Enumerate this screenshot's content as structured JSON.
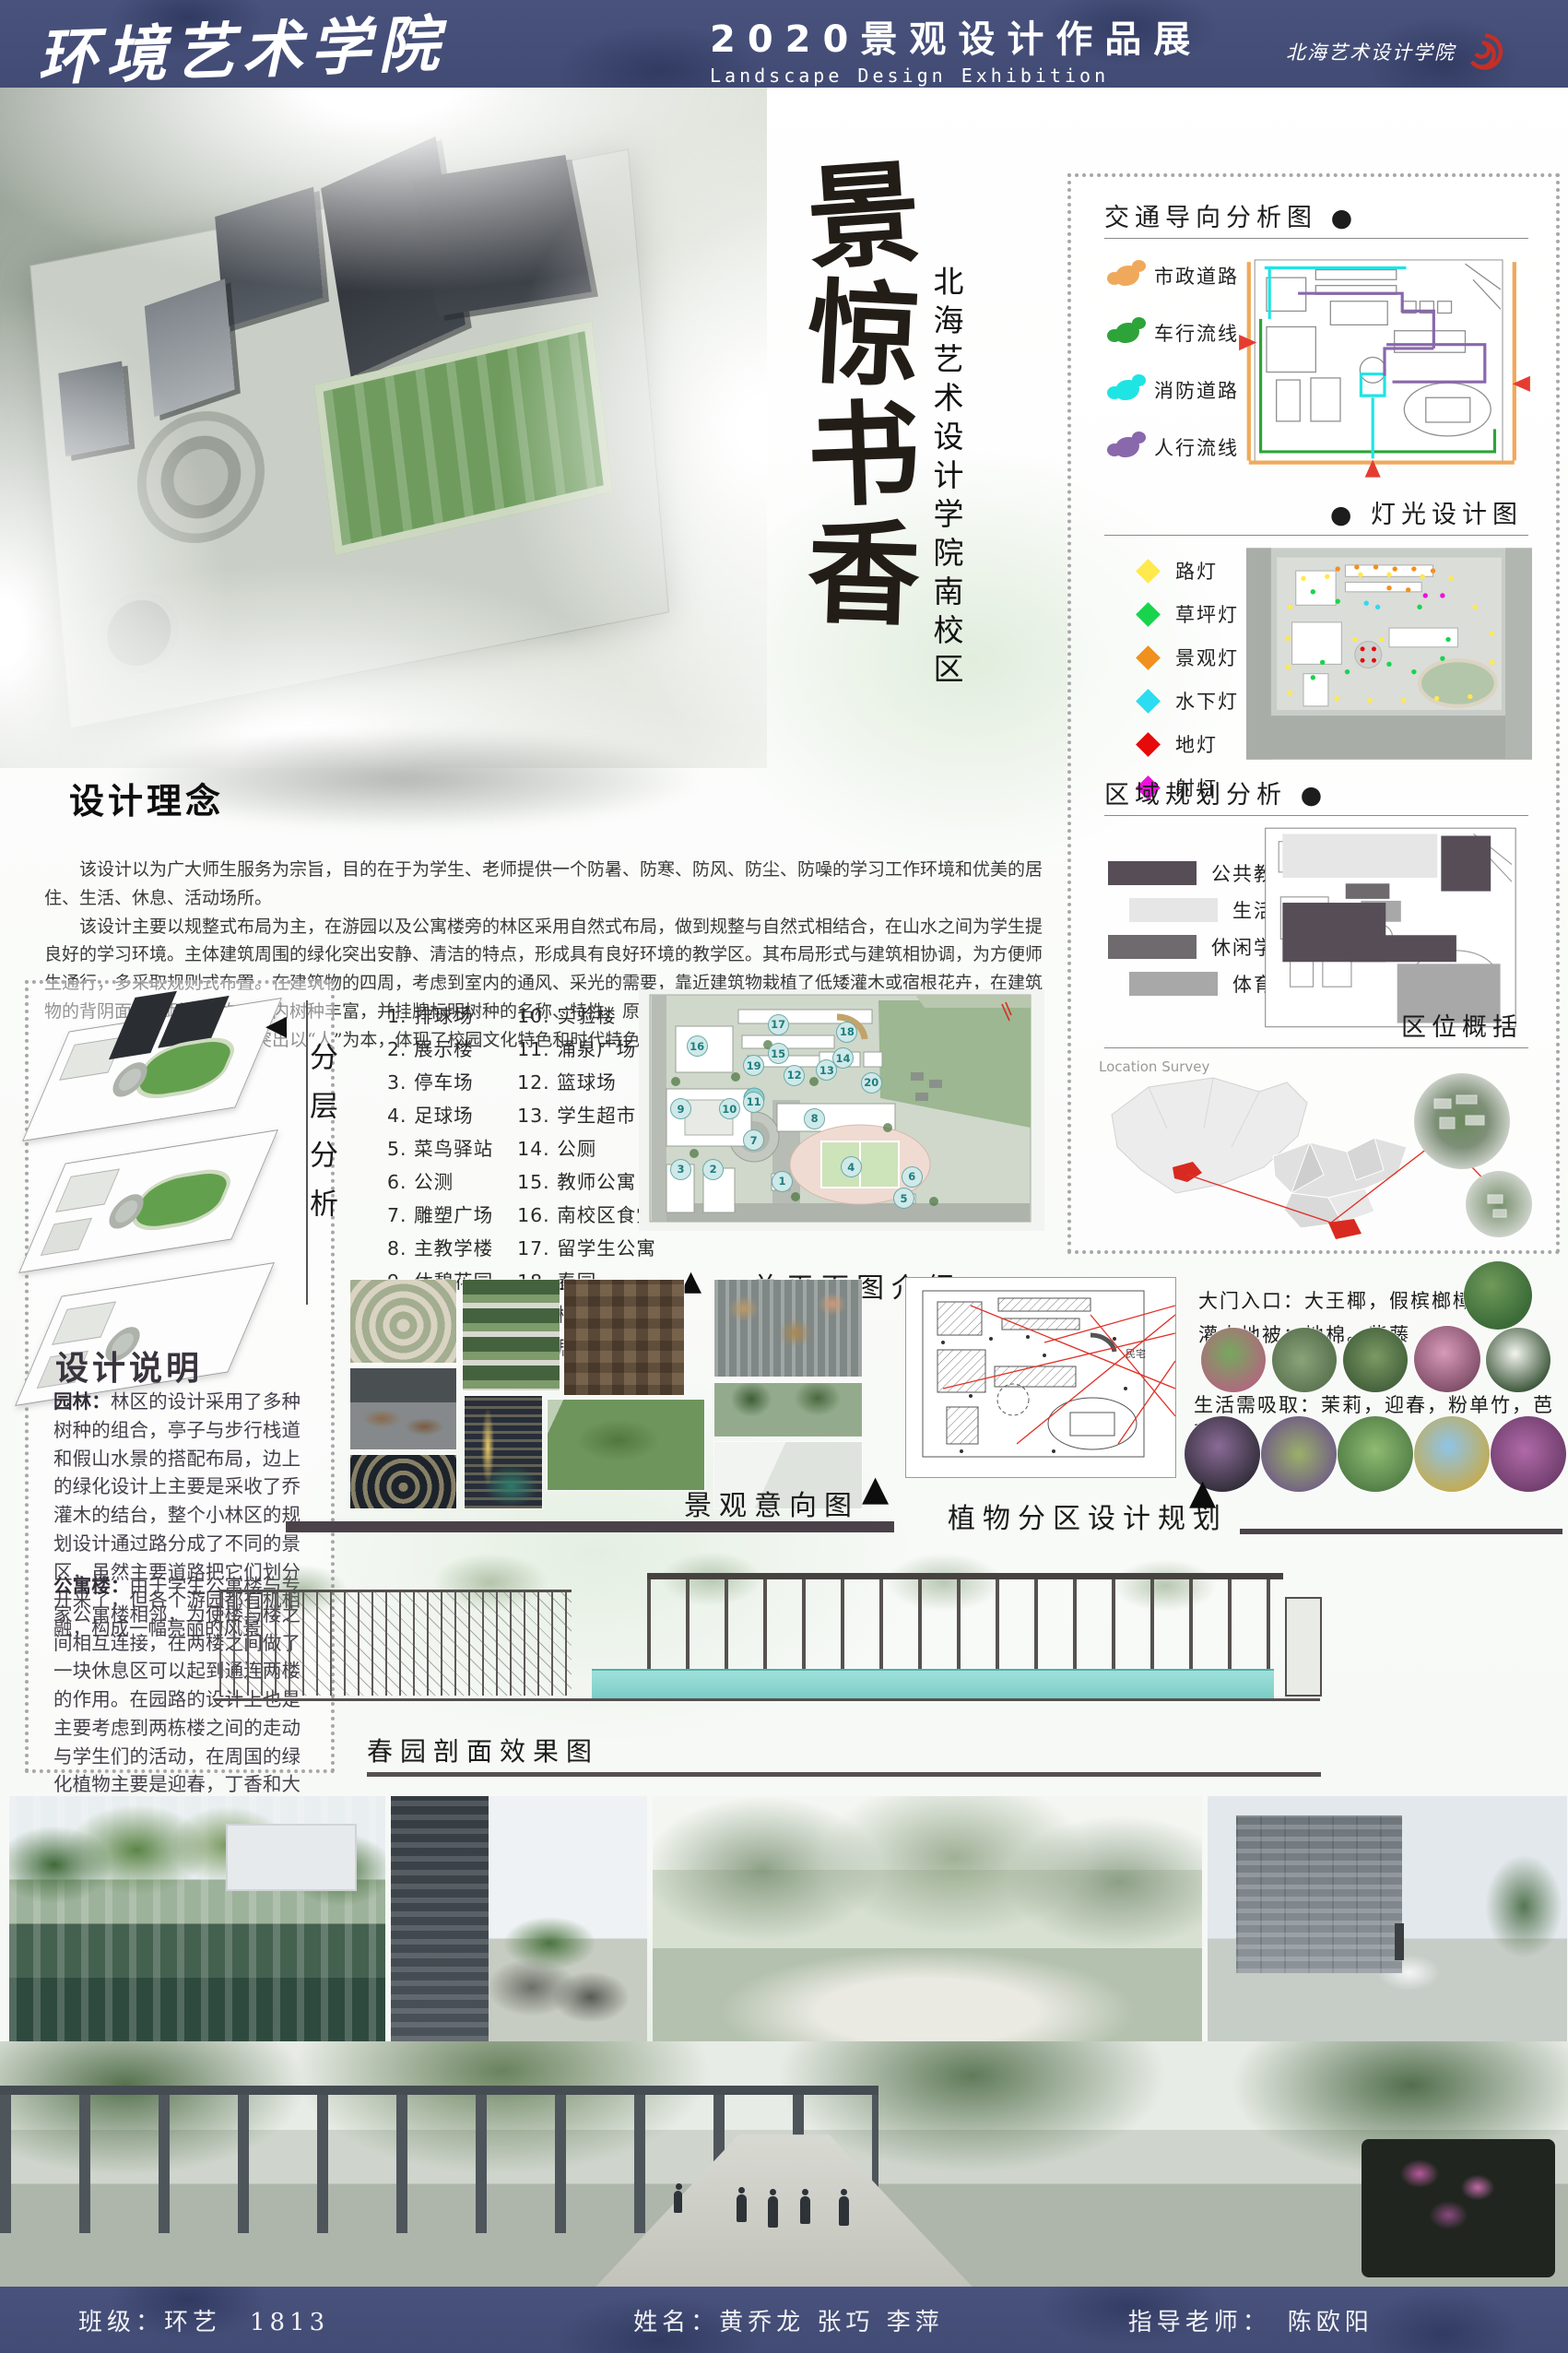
{
  "header": {
    "school": "环境艺术学院",
    "title": "2020景观设计作品展",
    "subtitle": "Landscape Design Exhibition",
    "logo_text": "北海艺术设计学院"
  },
  "hero": {
    "chars": [
      "景",
      "惊",
      "书",
      "香"
    ],
    "subtitle": "北海艺术设计学院南校区"
  },
  "panels": {
    "traffic": {
      "title": "交通导向分析图",
      "bullet": "●",
      "legend": [
        {
          "label": "市政道路",
          "color": "#f0a95c"
        },
        {
          "label": "车行流线",
          "color": "#2ea33a"
        },
        {
          "label": "消防道路",
          "color": "#1fe4e4"
        },
        {
          "label": "人行流线",
          "color": "#8968ab"
        }
      ]
    },
    "lighting": {
      "title": "灯光设计图",
      "bullet": "●",
      "legend": [
        {
          "label": "路灯",
          "color": "#ffe94d"
        },
        {
          "label": "草坪灯",
          "color": "#18d44c"
        },
        {
          "label": "景观灯",
          "color": "#f0901e"
        },
        {
          "label": "水下灯",
          "color": "#2cdcf0"
        },
        {
          "label": "地灯",
          "color": "#e60a0a"
        },
        {
          "label": "射灯",
          "color": "#ee10dd"
        }
      ]
    },
    "zoning": {
      "title": "区域规划分析",
      "bullet": "●",
      "legend": [
        {
          "label": "公共教学区",
          "color": "#564d57"
        },
        {
          "label": "生活区",
          "color": "#e6e6e6"
        },
        {
          "label": "休闲学习区",
          "color": "#6e6a6e"
        },
        {
          "label": "体育区",
          "color": "#a8a8a8"
        }
      ]
    },
    "location": {
      "title": "区位概括",
      "caption": "Location Survey"
    }
  },
  "concept": {
    "title": "设计理念",
    "paragraphs": [
      "该设计以为广大师生服务为宗旨，目的在于为学生、老师提供一个防暑、防寒、防风、防尘、防噪的学习工作环境和优美的居住、生活、休息、活动场所。",
      "该设计主要以规整式布局为主，在游园以及公寓楼旁的林区采用自然式布局，做到规整与自然式相结合，在山水之间为学生提良好的学习环境。主体建筑周围的绿化突出安静、清洁的特点，形成具有良好环境的教学区。其布局形式与建筑相协调，为方便师生通行，多采取规则式布置。在建筑物的四周，考虑到室内的通风、采光的需要，靠近建筑物栽植了低矮灌木或宿根花卉，在建筑物的背阴面选用耐荫植物。园内树种丰富，并挂牌标明树种的名称、特性、原产地等，使整个校园成为普及生物学知识的园地。",
      "本设计中设计理念主要突出以“人”为本，体现了校园文化特色和时代特色。"
    ]
  },
  "layers": {
    "label": "分层分析"
  },
  "description": {
    "title": "设计说明",
    "sections": [
      {
        "term": "园林：",
        "text": "林区的设计采用了多种树种的组合，亭子与步行栈道和假山水景的搭配布局，边上的绿化设计上主要是采收了乔灌木的结台，整个小林区的规划设计通过路分成了不同的景区，虽然主要道路把它们划分开来了，但各个游园都有机相融，构成一幅亮丽的风景"
      },
      {
        "term": "公寓楼：",
        "text": "由于学生公寓楼与专家公寓楼相邻，为使楼与楼之间相互连接，在两楼之间做了一块休息区可以起到通连两楼的作用。在园路的设计上也是主要考虑到两栋楼之间的走动与学生们的活动，在周国的绿化植物主要是迎春，丁香和大王椰等，给人一种花香四溢的感觉。"
      }
    ]
  },
  "plan": {
    "label": "总平面图介绍",
    "items_col1": [
      "1. 排球场",
      "2. 展示楼",
      "3. 停车场",
      "4. 足球场",
      "5. 菜鸟驿站",
      "6. 公测",
      "7. 雕塑广场",
      "8. 主教学楼",
      "9. 休憩花园"
    ],
    "items_col2": [
      "10. 实验楼",
      "11. 涌泉广场",
      "12. 篮球场",
      "13. 学生超市",
      "14. 公厕",
      "15. 教师公寓",
      "16. 南校区食堂",
      "17. 留学生公寓",
      "18. 春园",
      "19. 梅园",
      "20. 居民区"
    ],
    "markers": [
      {
        "n": 1,
        "x": 35,
        "y": 79
      },
      {
        "n": 2,
        "x": 18,
        "y": 74
      },
      {
        "n": 3,
        "x": 10,
        "y": 74
      },
      {
        "n": 4,
        "x": 52,
        "y": 73
      },
      {
        "n": 5,
        "x": 65,
        "y": 86
      },
      {
        "n": 6,
        "x": 67,
        "y": 77
      },
      {
        "n": 7,
        "x": 28,
        "y": 62
      },
      {
        "n": 8,
        "x": 43,
        "y": 53
      },
      {
        "n": 9,
        "x": 10,
        "y": 49
      },
      {
        "n": 10,
        "x": 22,
        "y": 49
      },
      {
        "n": 11,
        "x": 28,
        "y": 46
      },
      {
        "n": 12,
        "x": 38,
        "y": 35
      },
      {
        "n": 13,
        "x": 46,
        "y": 33
      },
      {
        "n": 14,
        "x": 50,
        "y": 28
      },
      {
        "n": 15,
        "x": 34,
        "y": 26
      },
      {
        "n": 16,
        "x": 14,
        "y": 23
      },
      {
        "n": 17,
        "x": 34,
        "y": 14
      },
      {
        "n": 18,
        "x": 51,
        "y": 17
      },
      {
        "n": 19,
        "x": 28,
        "y": 31
      },
      {
        "n": 20,
        "x": 57,
        "y": 38
      }
    ]
  },
  "labels": {
    "intent": "景观意向图",
    "plant": "植物分区设计规划",
    "section_view": "春园剖面效果图"
  },
  "plants": {
    "line1": "大门入口：大王椰，假槟榔樟树",
    "line2": "灌木地被：地棉。紫藤",
    "line3": "生活需吸取：茉莉，迎春，粉单竹，芭蕉",
    "plan_note": "民宅"
  },
  "footer": {
    "class_label": "班级：环艺　1813",
    "names": "姓名：黄乔龙 张巧 李萍",
    "advisor": "指导老师：　陈欧阳"
  }
}
